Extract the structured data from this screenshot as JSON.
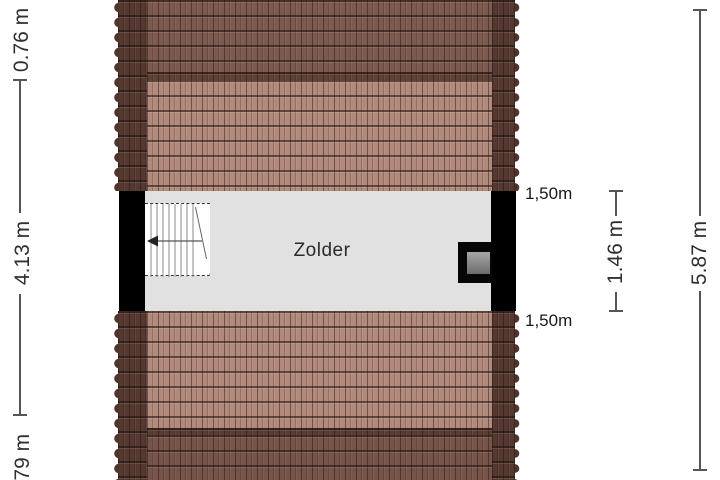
{
  "room": {
    "label": "Zolder"
  },
  "dimensions": {
    "left_top": "0.76 m",
    "left_middle": "4.13 m",
    "left_bottom": "0.79 m",
    "right_inner": "1.46 m",
    "right_outer": "5.87 m",
    "wall_top": "1,50m",
    "wall_bottom": "1,50m"
  },
  "icons": {
    "stair_arrow": "arrow-left",
    "roof_window": "roof-window"
  },
  "colors": {
    "roof_edge": "#553931",
    "roof_upper_band": "#7d5a4f",
    "roof_ridge": "#5e4036",
    "roof_field_pink": "#b28a7c",
    "roof_eave": "#5a3c33",
    "roof_lower_band": "#765449",
    "floor_gray": "#e2e1e1",
    "wall_black": "#000000",
    "window_pane_gray": "#8f8f8f",
    "dimension_text": "#303030",
    "background": "#ffffff"
  }
}
